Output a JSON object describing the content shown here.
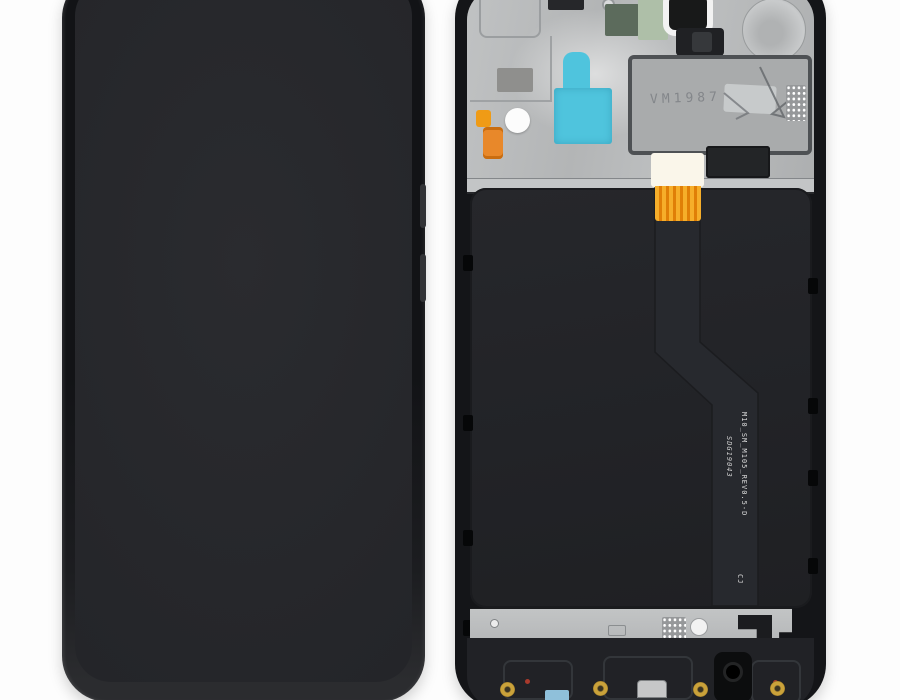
{
  "photo": {
    "background": "#fdfdfd",
    "markings": {
      "shield_etch": "VM1987",
      "flex_line1": "M10_SM_M105_REV0.5-D",
      "flex_line2": "SDG19043",
      "flex_suffix": "CJ"
    },
    "colors": {
      "phone_body": "#17181a",
      "screen": "#26272b",
      "assembly_frame": "#141518",
      "shield_metal": "#b5b7b8",
      "panel_back": "#232428",
      "sticker_cyan": "#4fc4dd",
      "flex_orange": "#ef9b16",
      "ribbon_gold": "#f6ae2a",
      "screw_gold": "#caa23a",
      "pcb_green_light": "#aebfa8",
      "pcb_green_dark": "#5c6b5c",
      "headphone_jack": "#0c0d0e",
      "sticker_blue": "#8fc0da"
    }
  }
}
